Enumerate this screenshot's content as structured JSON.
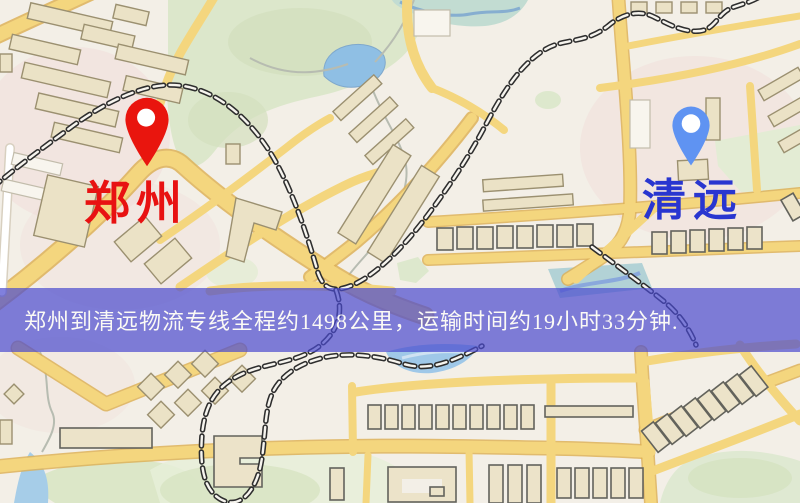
{
  "page": {
    "width": 800,
    "height": 503,
    "kind": "logistics-route-map-image"
  },
  "map": {
    "markers": [
      {
        "id": "origin",
        "label": "郑州",
        "pin_color": "#e9150e",
        "label_color": "#e81212",
        "pin_style": "red-teardrop"
      },
      {
        "id": "destination",
        "label": "清远",
        "pin_color": "#5f93f2",
        "label_color": "#2936d0",
        "pin_style": "blue-teardrop"
      }
    ],
    "banner": {
      "text": "郑州到清远物流专线全程约1498公里，运输时间约19小时33分钟.",
      "background_color": "#4a4ace",
      "text_color": "#fbfaf5"
    },
    "route": {
      "origin": "郑州",
      "destination": "清远",
      "distance_text": "约1498公里",
      "duration_text": "约19小时33分钟"
    },
    "palette": {
      "background": "#f3efe7",
      "road_yellow": "#f4d67e",
      "park_green": "#dce7cb",
      "water_blue": "#8fbfe4",
      "railway_black": "#2e2e2e",
      "building_beige": "#ebe2c6"
    }
  }
}
